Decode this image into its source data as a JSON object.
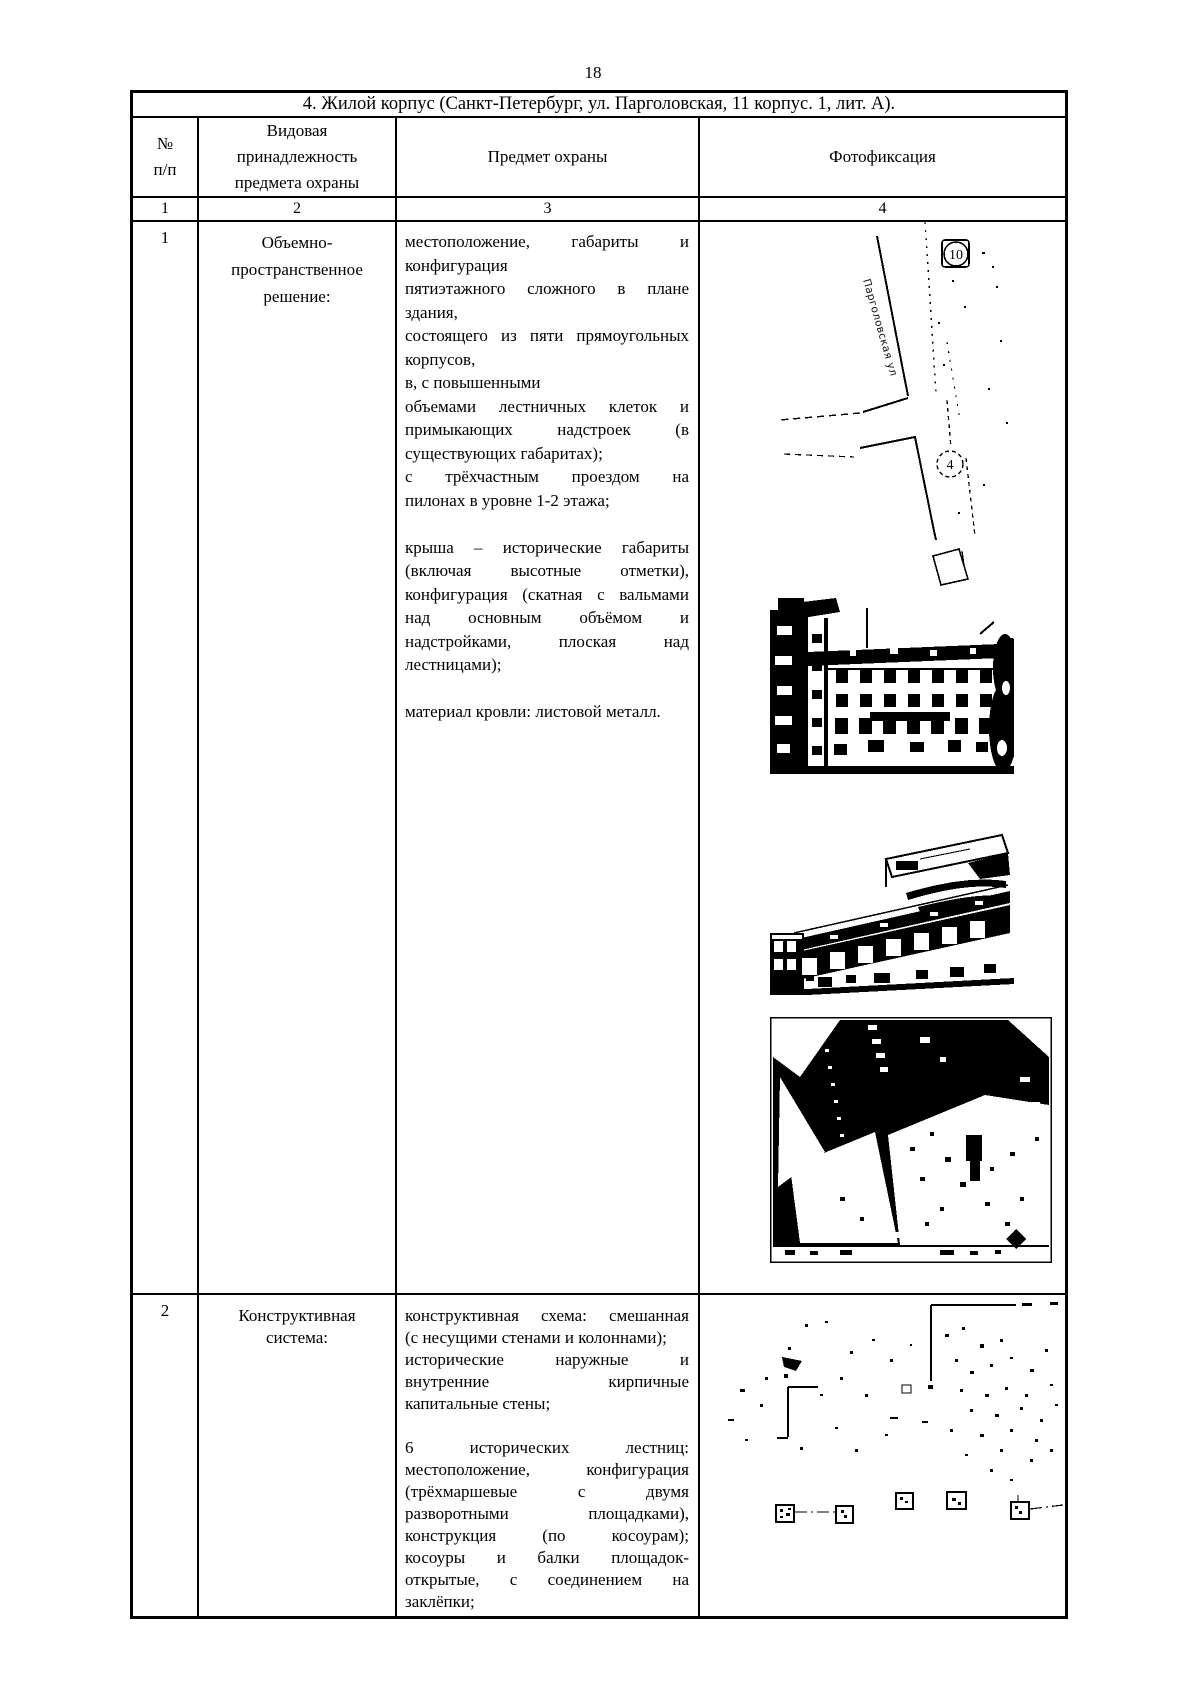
{
  "page": {
    "number": "18"
  },
  "doc_table": {
    "title": "4. Жилой корпус (Санкт-Петербург, ул. Парголовская, 11 корпус. 1, лит. А).",
    "headers": {
      "col1": [
        "№",
        "п/п"
      ],
      "col2": [
        "Видовая",
        "принадлежность",
        "предмета охраны"
      ],
      "col3": [
        "Предмет охраны"
      ],
      "col4": [
        "Фотофиксация"
      ]
    },
    "column_numbers": [
      "1",
      "2",
      "3",
      "4"
    ],
    "rows": [
      {
        "num": "1",
        "category": [
          "Объемно-",
          "пространственное",
          "решение:"
        ],
        "subject": [
          {
            "t": "местоположение, габариты и",
            "j": true
          },
          {
            "t": "конфигурация",
            "j": false
          },
          {
            "t": "пятиэтажного сложного в плане",
            "j": true
          },
          {
            "t": "здания,",
            "j": false
          },
          {
            "t": "состоящего из пяти прямоугольных",
            "j": true
          },
          {
            "t": "корпусов,",
            "j": false
          },
          {
            "t": "в, с повышенными",
            "j": false
          },
          {
            "t": "объемами лестничных клеток и",
            "j": true
          },
          {
            "t": "примыкающих надстроек (в",
            "j": true
          },
          {
            "t": "существующих габаритах);",
            "j": false
          },
          {
            "t": "с трёхчастным проездом на",
            "j": true
          },
          {
            "t": "пилонах в уровне 1-2 этажа;",
            "j": false
          },
          {
            "t": "",
            "j": false
          },
          {
            "t": "крыша – исторические габариты",
            "j": true
          },
          {
            "t": "(включая высотные отметки),",
            "j": true
          },
          {
            "t": "конфигурация (скатная с вальмами",
            "j": true
          },
          {
            "t": "над основным объёмом и",
            "j": true
          },
          {
            "t": "надстройками, плоская над",
            "j": true
          },
          {
            "t": "лестницами);",
            "j": false
          },
          {
            "t": "",
            "j": false
          },
          {
            "t": "материал кровли: листовой металл.",
            "j": false
          }
        ],
        "map_labels": {
          "street": "Парголовская ул",
          "marker_top": "10",
          "marker_site": "4"
        }
      },
      {
        "num": "2",
        "category": [
          "Конструктивная",
          "система:"
        ],
        "subject": [
          {
            "t": "конструктивная схема: смешанная",
            "j": true
          },
          {
            "t": "(с несущими стенами и колоннами);",
            "j": false
          },
          {
            "t": "исторические наружные и",
            "j": true
          },
          {
            "t": "внутренние кирпичные",
            "j": true
          },
          {
            "t": "капитальные стены;",
            "j": false
          },
          {
            "t": "",
            "j": false
          },
          {
            "t": "6 исторических лестниц:",
            "j": true
          },
          {
            "t": "местоположение, конфигурация",
            "j": true
          },
          {
            "t": "(трёхмаршевые с двумя",
            "j": true
          },
          {
            "t": "разворотными площадками),",
            "j": true
          },
          {
            "t": "конструкция (по косоурам);",
            "j": true
          },
          {
            "t": "косоуры и балки площадок-",
            "j": true
          },
          {
            "t": "открытые, с соединением на",
            "j": true
          },
          {
            "t": "заклёпки;",
            "j": false
          }
        ]
      }
    ]
  }
}
